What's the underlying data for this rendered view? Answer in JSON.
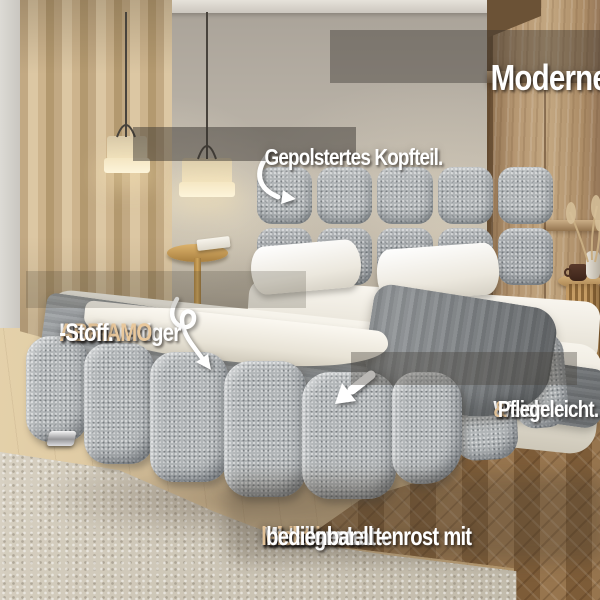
{
  "language": "de",
  "colors": {
    "accent_tan": "#e9c89c",
    "text_white": "#ffffff",
    "badge_gray": "rgba(58,53,48,0.42)",
    "bed_fabric_gray": "#b2b6b8",
    "wall_greige": "#b6afa4",
    "wood_floor": "#c4a87e",
    "parquet_brown": "#8b6944"
  },
  "labels": {
    "headline": "Modernes Design",
    "headboard": "Gepolstertes Kopfteil.",
    "fabric": {
      "pre": "Hochwertiger ",
      "brand": "ABRIAMO",
      "post": "-Stoff."
    },
    "softness": {
      "pre": "Weich ",
      "amp": "&",
      "post": " Pflegeleicht."
    },
    "slats_line1": {
      "accent": "Inklusive",
      "rest": " stabilem Lattenrost mit"
    },
    "slats_line2": {
      "pre": "Metallgestell – ",
      "accent": "leicht",
      "post": " bedienbar."
    }
  },
  "icons": {
    "headboard_arrow": "curved-arrow-down-right",
    "fabric_arrow": "heart-loop-arrow-down",
    "softness_arrow": "thick-arrow-down-left"
  }
}
